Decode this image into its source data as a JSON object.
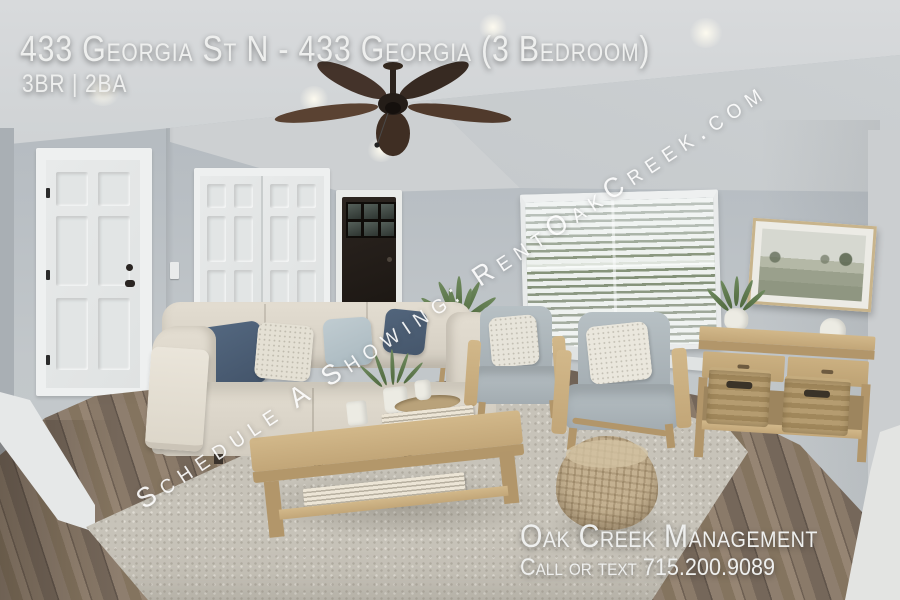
{
  "overlay": {
    "title": "433 Georgia St N - 433 Georgia (3 Bedroom)",
    "specs": "3BR | 2BA",
    "watermark": "Schedule A Showing: RentOakCreek.com",
    "company": "Oak Creek Management",
    "contact": "Call or text 715.200.9089"
  },
  "colors": {
    "overlay_text": "#eeefee",
    "watermark_text": "#ffffff",
    "wall": "#b9bfc4",
    "ceiling": "#d2d5d7",
    "floor_wood": "#87776a",
    "rug": "#c7c3b9",
    "sofa_fabric": "#ddd7cb",
    "pillow_navy": "#4d6075",
    "armchair_fabric": "#aeb7bc",
    "oak_wood": "#c9ae80",
    "front_door": "#26201b",
    "plant_green": "#5e7a4e"
  }
}
